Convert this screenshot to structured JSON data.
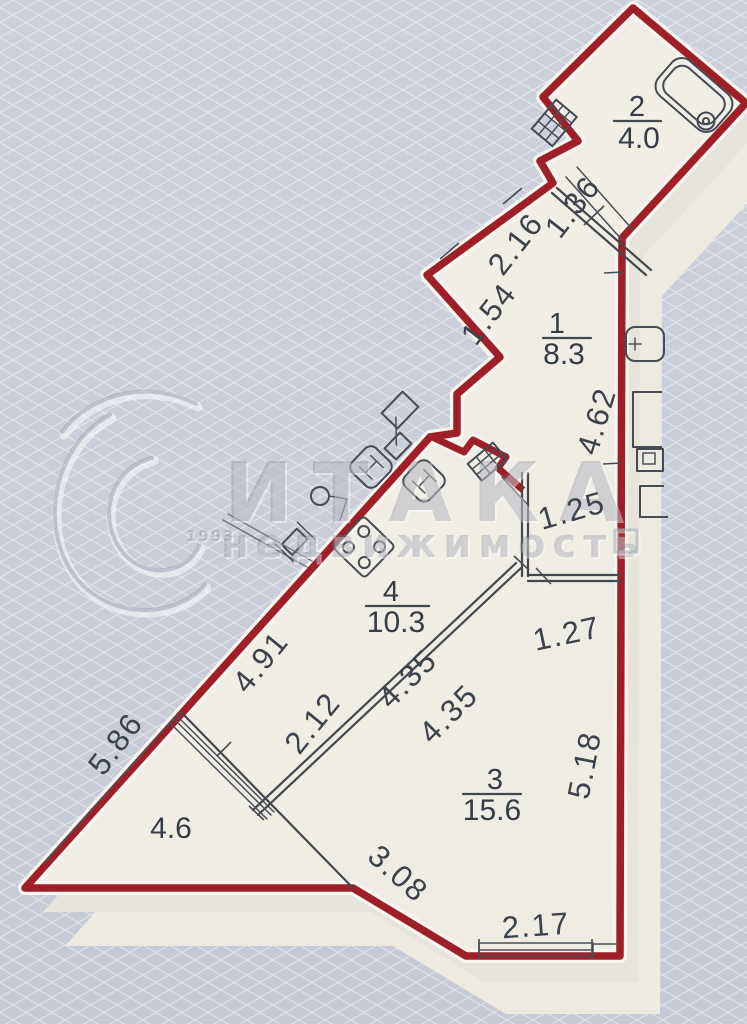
{
  "page": {
    "type": "floor-plan",
    "style": "3d-extruded-render"
  },
  "watermark": {
    "year": "1993",
    "title": "ИТАКА",
    "subtitle": "недвижимость"
  },
  "rooms": {
    "room1": {
      "number": "1",
      "area": "8.3"
    },
    "room2": {
      "number": "2",
      "area": "4.0"
    },
    "room3": {
      "number": "3",
      "area": "15.6"
    },
    "room4": {
      "number": "4",
      "area": "10.3"
    },
    "balcony": {
      "area": "4.6"
    }
  },
  "dims": {
    "d1": {
      "value": "1.36"
    },
    "d2": {
      "value": "2.16"
    },
    "d3": {
      "value": "1.54"
    },
    "d4": {
      "value": "4.62"
    },
    "d5": {
      "value": "1.25"
    },
    "d6": {
      "value": "1.27"
    },
    "d7": {
      "value": "4.91"
    },
    "d8": {
      "value": "2.12"
    },
    "d9": {
      "value": "4.35"
    },
    "d10": {
      "value": "4.35"
    },
    "d11": {
      "value": "5.86"
    },
    "d12": {
      "value": "3.08"
    },
    "d13": {
      "value": "5.18"
    },
    "d14": {
      "value": "2.17"
    }
  },
  "colors": {
    "boundary": "#9e1f27",
    "floor": "#f1efe7",
    "background": "#cbcfd9",
    "lines": "#43484f",
    "watermark": "#788093"
  }
}
